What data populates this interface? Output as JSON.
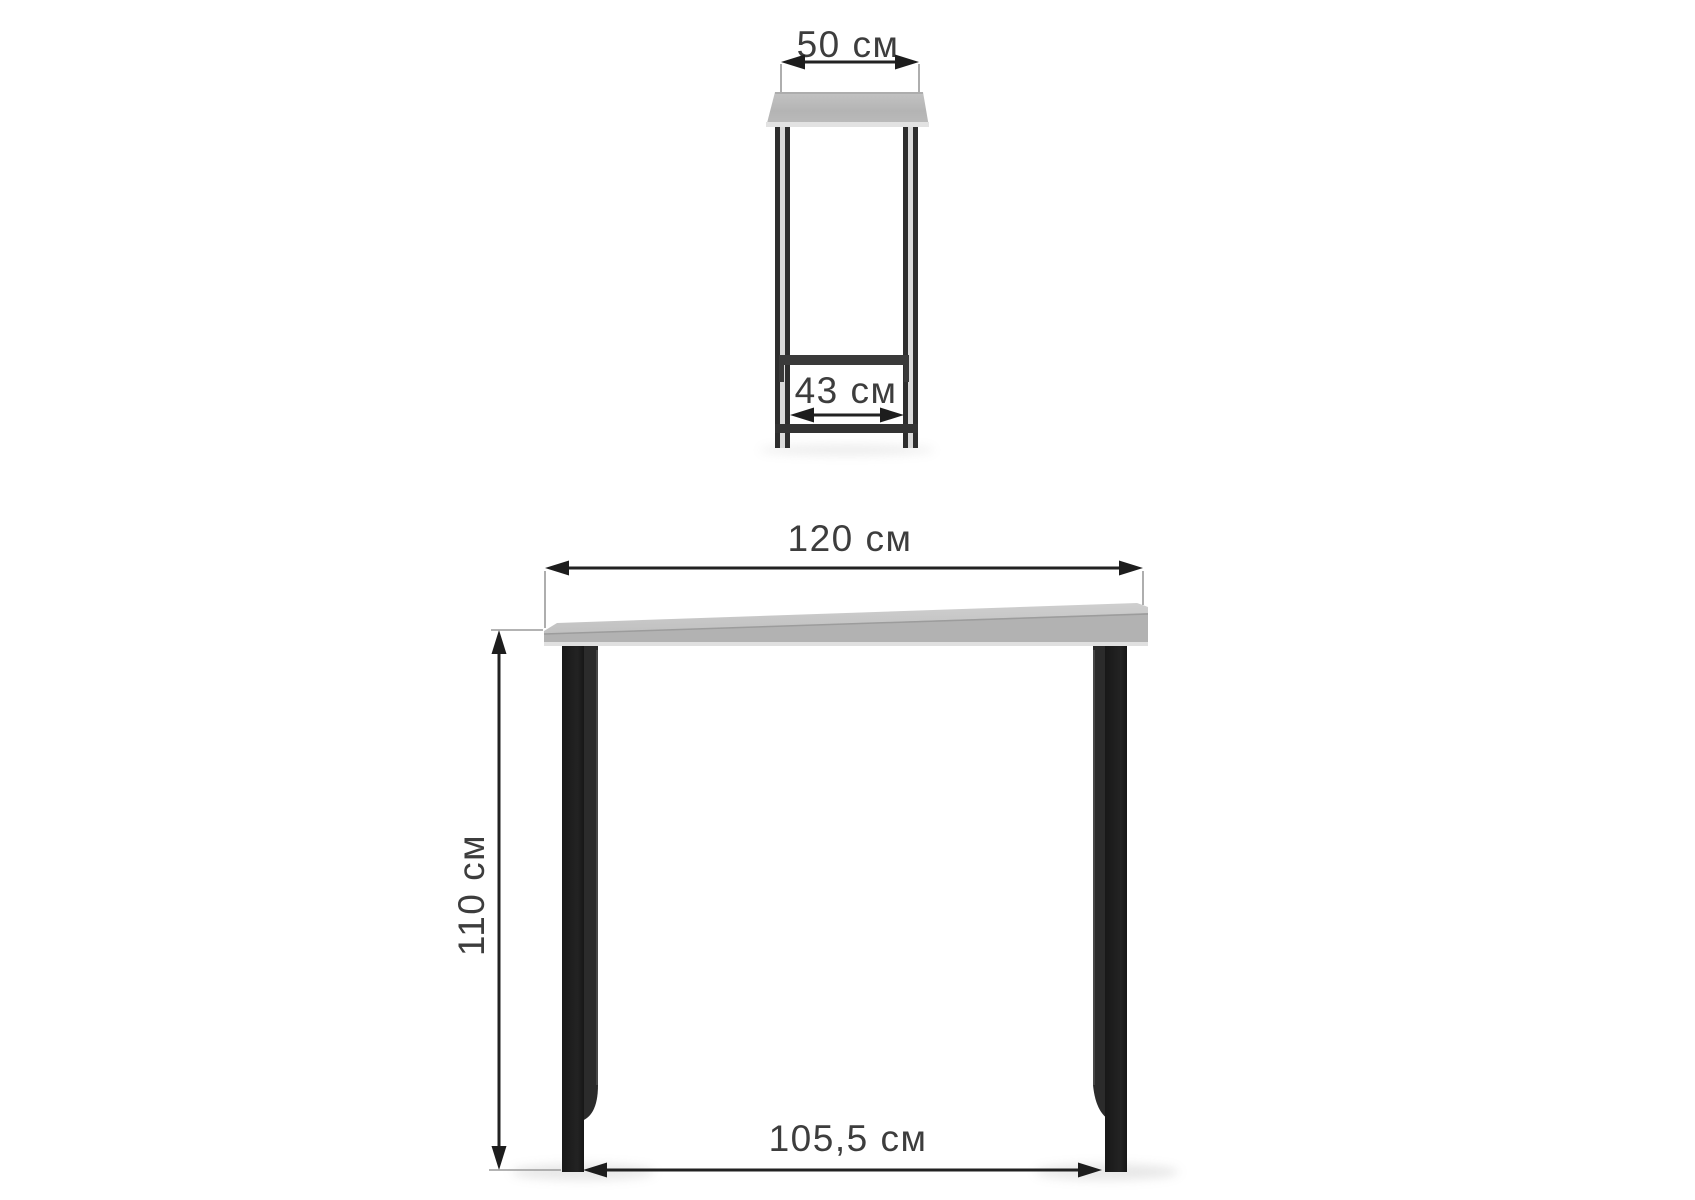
{
  "background_color": "#ffffff",
  "unit": "см",
  "colors": {
    "dimension_line": "#222222",
    "extension_line": "#9a9a9a",
    "label_text": "#3d3d3d",
    "tabletop_gray": "#bcbcbc",
    "tabletop_edge_highlight": "#e0e0e0",
    "leg_black": "#1b1b1b",
    "frame_dark": "#333333"
  },
  "side_view": {
    "dimensions": {
      "tabletop_depth": {
        "label": "50 см",
        "value": 50
      },
      "base_inner_depth": {
        "label": "43 см",
        "value": 43
      }
    }
  },
  "front_view": {
    "dimensions": {
      "tabletop_width": {
        "label": "120 см",
        "value": 120
      },
      "height": {
        "label": "110 см",
        "value": 110
      },
      "base_inner_width": {
        "label": "105,5 см",
        "value": 105.5
      }
    }
  }
}
